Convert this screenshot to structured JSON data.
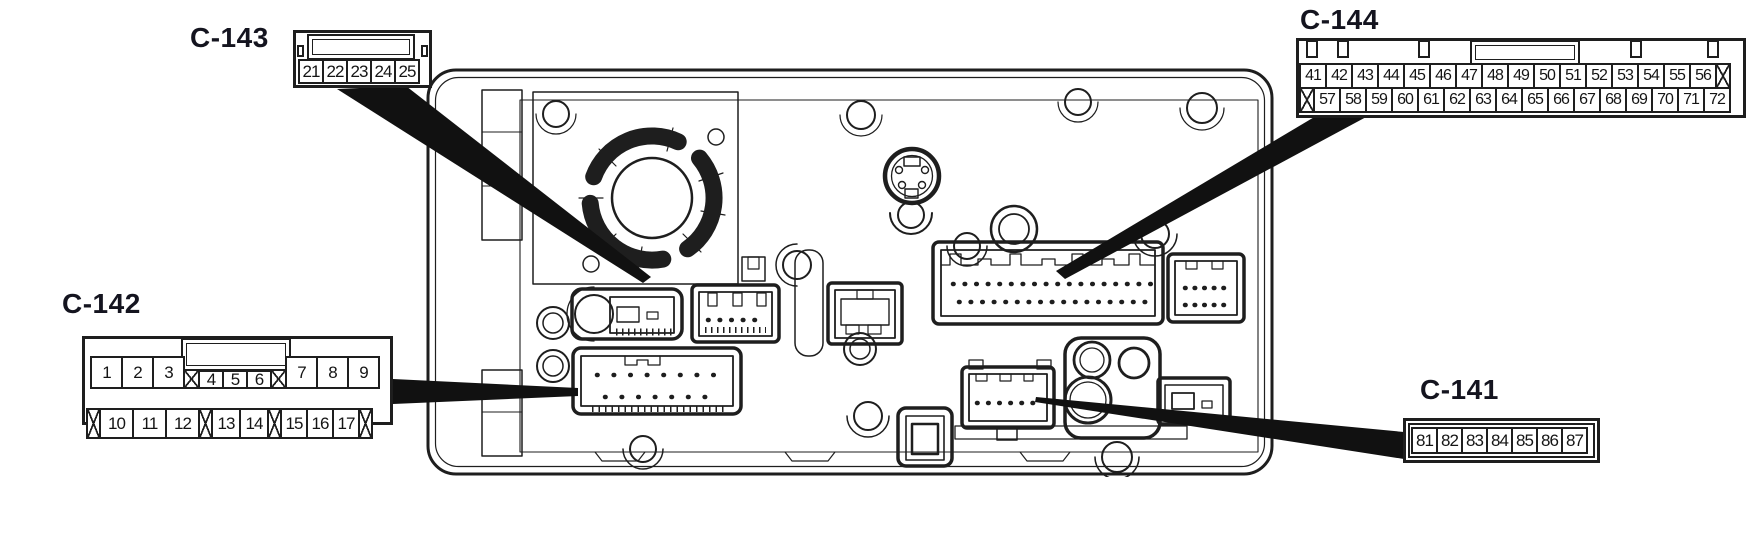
{
  "figure": {
    "kind": "connector location diagram",
    "unit": "audio unit rear view"
  },
  "colors": {
    "line": "#1e1e1e",
    "label": "#14141f",
    "background": "#ffffff"
  },
  "callouts": {
    "c143": {
      "label": "C-143",
      "rows": [
        [
          {
            "t": "21"
          },
          {
            "t": "22"
          },
          {
            "t": "23"
          },
          {
            "t": "24"
          },
          {
            "t": "25"
          }
        ]
      ]
    },
    "c144": {
      "label": "C-144",
      "rows": [
        [
          {
            "t": "41"
          },
          {
            "t": "42"
          },
          {
            "t": "43"
          },
          {
            "t": "44"
          },
          {
            "t": "45"
          },
          {
            "t": "46"
          },
          {
            "t": "47"
          },
          {
            "t": "48"
          },
          {
            "t": "49"
          },
          {
            "t": "50"
          },
          {
            "t": "51"
          },
          {
            "t": "52"
          },
          {
            "t": "53"
          },
          {
            "t": "54"
          },
          {
            "t": "55"
          },
          {
            "t": "56"
          },
          {
            "v": "x"
          }
        ],
        [
          {
            "v": "x"
          },
          {
            "t": "57"
          },
          {
            "t": "58"
          },
          {
            "t": "59"
          },
          {
            "t": "60"
          },
          {
            "t": "61"
          },
          {
            "t": "62"
          },
          {
            "t": "63"
          },
          {
            "t": "64"
          },
          {
            "t": "65"
          },
          {
            "t": "66"
          },
          {
            "t": "67"
          },
          {
            "t": "68"
          },
          {
            "t": "69"
          },
          {
            "t": "70"
          },
          {
            "t": "71"
          },
          {
            "t": "72"
          }
        ]
      ]
    },
    "c142": {
      "label": "C-142",
      "rows": [
        [
          {
            "t": "1"
          },
          {
            "t": "2"
          },
          {
            "t": "3"
          },
          {
            "v": "xmid"
          },
          {
            "t": "4",
            "v": "small"
          },
          {
            "t": "5",
            "v": "small"
          },
          {
            "t": "6",
            "v": "small"
          },
          {
            "v": "xmid"
          },
          {
            "t": "7"
          },
          {
            "t": "8"
          },
          {
            "t": "9"
          }
        ],
        [
          {
            "v": "xn"
          },
          {
            "t": "10",
            "v": "b33"
          },
          {
            "t": "11",
            "v": "b33"
          },
          {
            "t": "12",
            "v": "b33"
          },
          {
            "v": "xn"
          },
          {
            "t": "13",
            "v": "b30"
          },
          {
            "t": "14",
            "v": "b30"
          },
          {
            "v": "xn"
          },
          {
            "t": "15",
            "v": "b26"
          },
          {
            "t": "16",
            "v": "b26"
          },
          {
            "t": "17",
            "v": "b26"
          },
          {
            "v": "xn"
          }
        ]
      ]
    },
    "c141": {
      "label": "C-141",
      "rows": [
        [
          {
            "t": "81"
          },
          {
            "t": "82"
          },
          {
            "t": "83"
          },
          {
            "t": "84"
          },
          {
            "t": "85"
          },
          {
            "t": "86"
          },
          {
            "t": "87"
          }
        ]
      ]
    }
  }
}
